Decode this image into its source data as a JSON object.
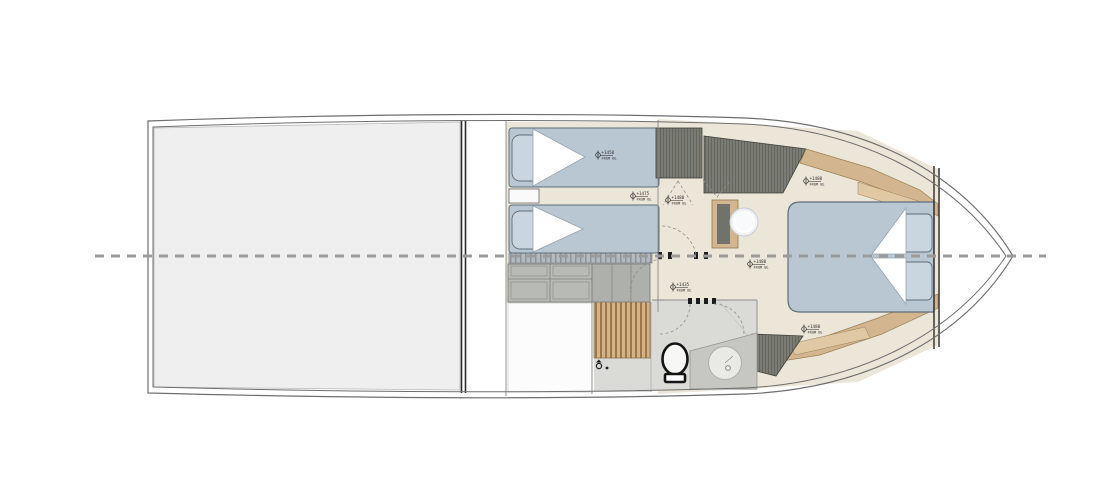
{
  "plan": {
    "markers": [
      {
        "value": "+1450",
        "datum": "FROM BL"
      },
      {
        "value": "+1475",
        "datum": "FROM BL"
      },
      {
        "value": "+1480",
        "datum": "FROM BL"
      },
      {
        "value": "+1480",
        "datum": "FROM BL"
      },
      {
        "value": "+1435",
        "datum": "FROM BL"
      },
      {
        "value": "+1480",
        "datum": "FROM BL"
      },
      {
        "value": "+1480",
        "datum": "FROM BL"
      }
    ],
    "colors": {
      "background": "#ffffff",
      "aft_panel": "#efefef",
      "floor_beige": "#ebe6d7",
      "subfloor_white": "#fcfcfc",
      "bed": "#b9c7d3",
      "pillow": "#c9d5df",
      "wood": "#d3b690",
      "wood_light": "#e0c8a4",
      "wardrobe_hatch": "#797b74",
      "cabinet_gray": "#b8bab5",
      "locker_gray": "#aeb0ab",
      "teak": "#d7b285",
      "marble": "#dadad7",
      "counter_gray": "#c6c6c3",
      "hull_line": "#6e6e6e",
      "centerline": "#9b9b9b",
      "wall": "#8a8a8a"
    },
    "fixtures": [
      "twin-bed-upper",
      "twin-bed-lower",
      "nightstand",
      "drawer-cabinet",
      "locker-doors",
      "teak-shower-grating",
      "shower-faucet",
      "toilet",
      "sink-counter",
      "washbasin",
      "vanity",
      "vanity-basin",
      "wardrobe-aft",
      "wardrobe-forward",
      "double-bed",
      "pillow",
      "hull-shelf-top",
      "hull-shelf-bottom",
      "hatched-seat",
      "bow-bulkhead"
    ]
  }
}
